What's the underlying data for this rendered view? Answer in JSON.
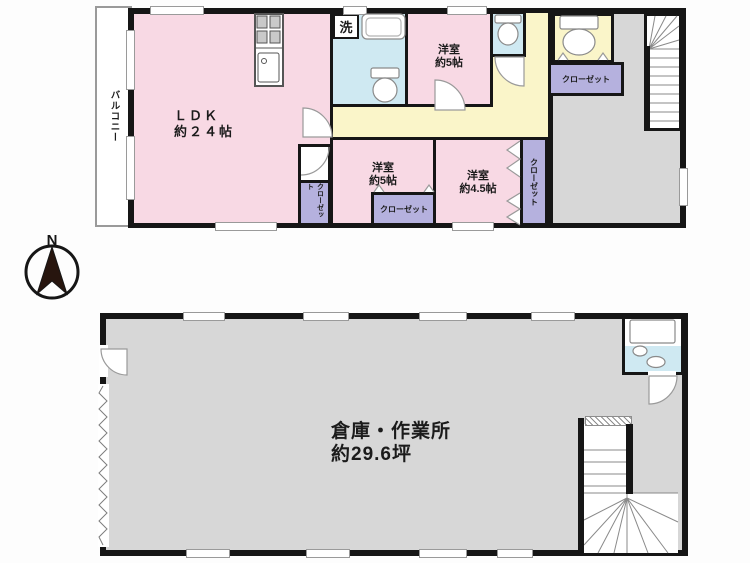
{
  "colors": {
    "wall": "#161616",
    "room_pink": "#f8d9e4",
    "corridor_yellow": "#faf5c9",
    "wet_blue": "#cfe9f2",
    "closet_purple": "#b5b1de",
    "hall_gray": "#d7d7d7"
  },
  "compass": {
    "north": "N"
  },
  "floor1": {
    "balcony": "バルコニー",
    "ldk": {
      "name": "ＬＤＫ",
      "size": "約２４帖"
    },
    "laundry": "洗",
    "bedroom_top": {
      "name": "洋室",
      "size": "約5帖"
    },
    "bedroom_mid": {
      "name": "洋室",
      "size": "約5帖"
    },
    "bedroom_small": {
      "name": "洋室",
      "size": "約4.5帖"
    },
    "closet_entry": "クローゼット",
    "closet_ldk": "クローゼット",
    "closet_mid": "クローゼット",
    "closet_side": "クローゼット"
  },
  "floor2": {
    "warehouse": {
      "name": "倉庫・作業所",
      "size": "約29.6坪"
    }
  }
}
